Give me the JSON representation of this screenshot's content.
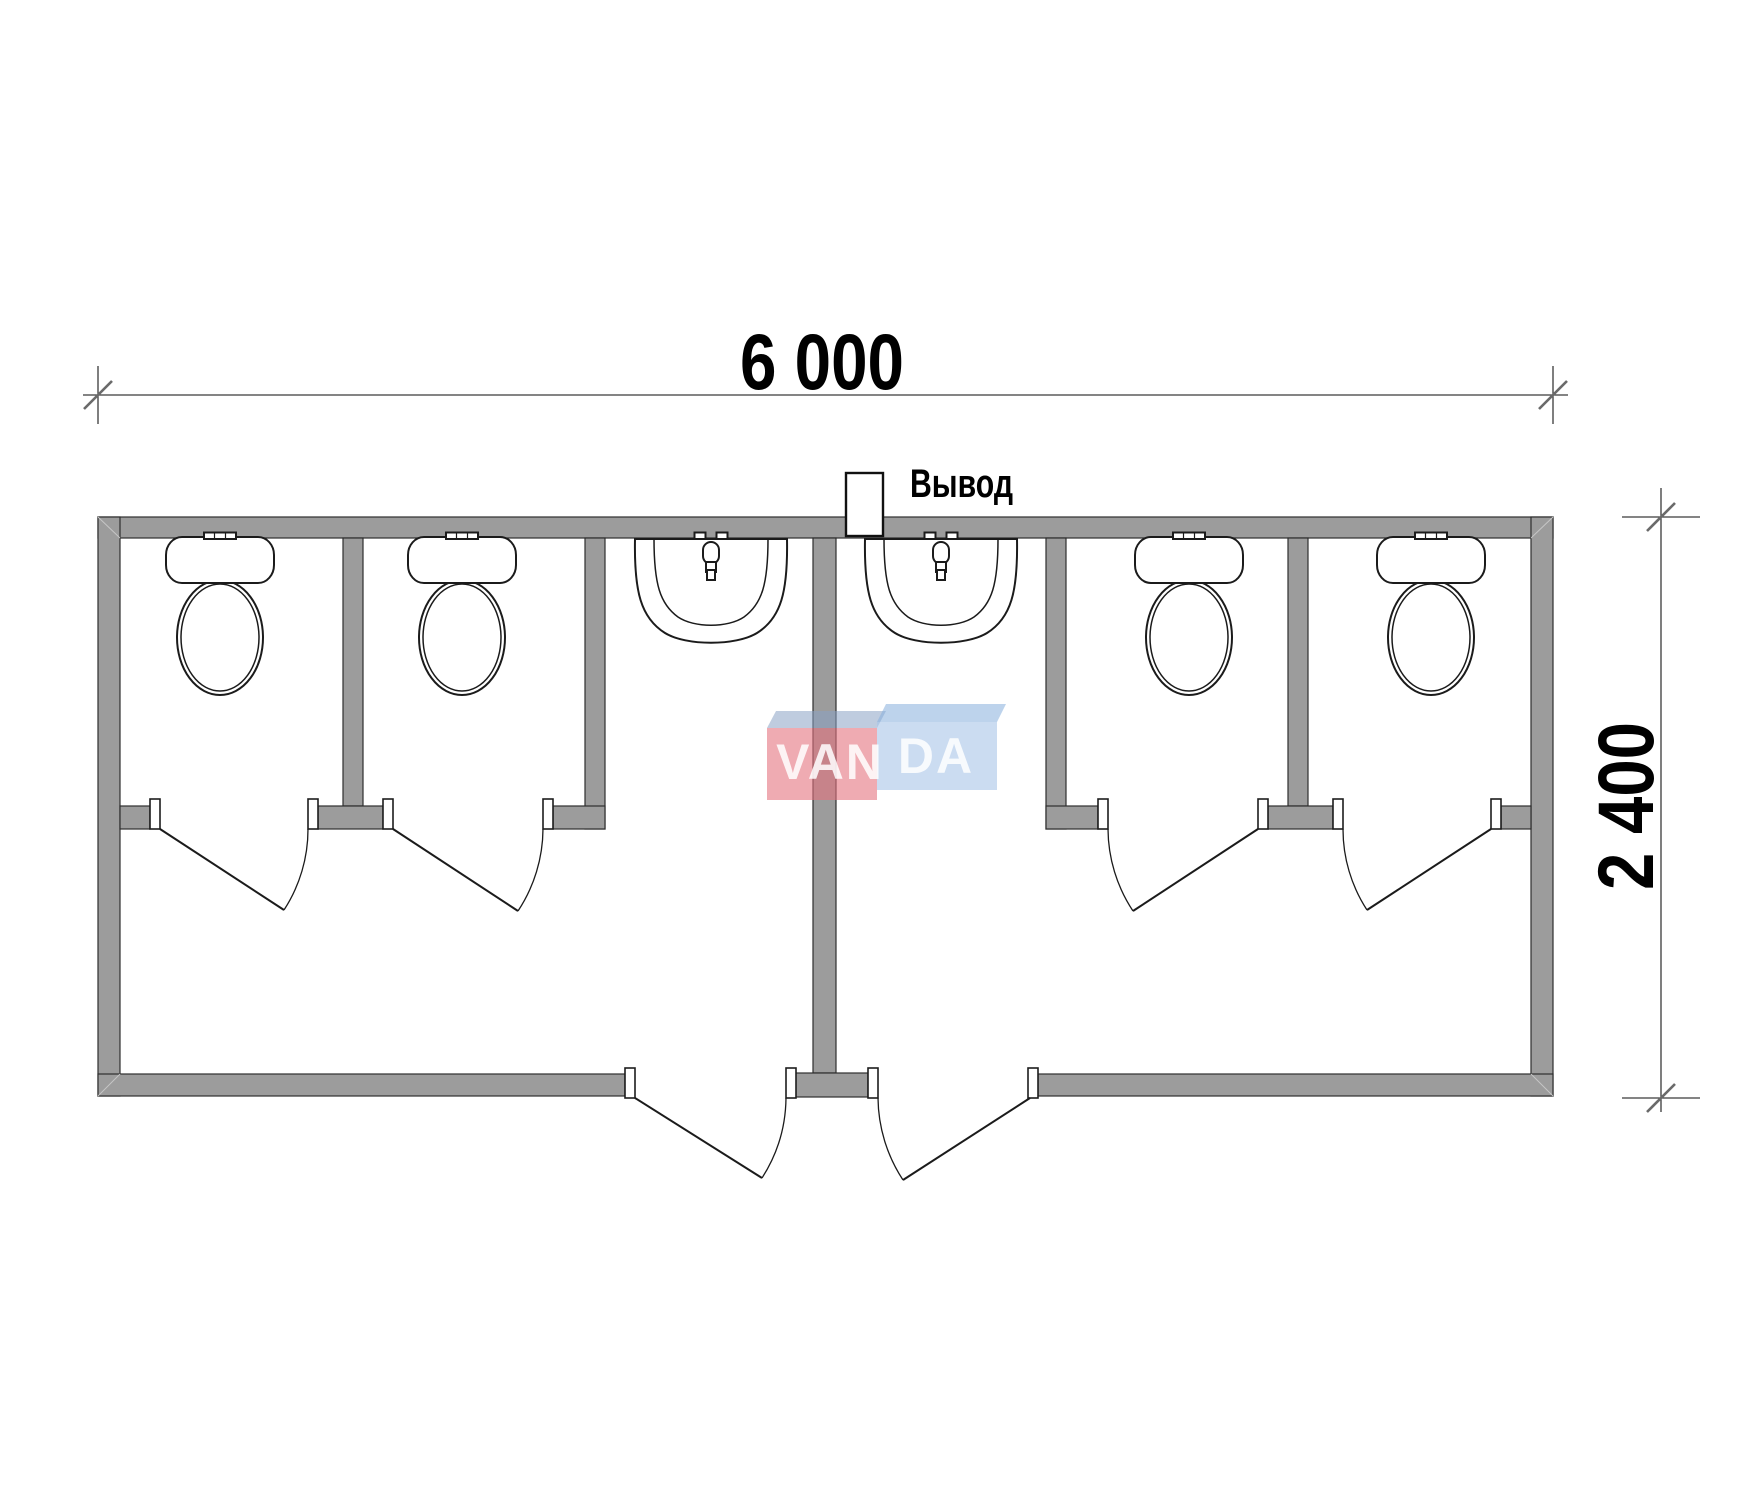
{
  "dimensions": {
    "width_label": "6 000",
    "height_label": "2 400"
  },
  "outlet": {
    "label": "Вывод"
  },
  "logo": {
    "left": "VAN",
    "right": "DA"
  },
  "colors": {
    "wall_fill": "#9c9c9c",
    "wall_stroke": "#2e2e2e",
    "line": "#1b1b1b",
    "dim": "#3a3a3a",
    "tick": "#6a6a6a",
    "logo_red": "#e4737e",
    "logo_red_top": "#8ba3c4",
    "logo_blue": "#a8c4e8",
    "logo_blue_top": "#86aedd",
    "logo_text": "#ffffff"
  }
}
